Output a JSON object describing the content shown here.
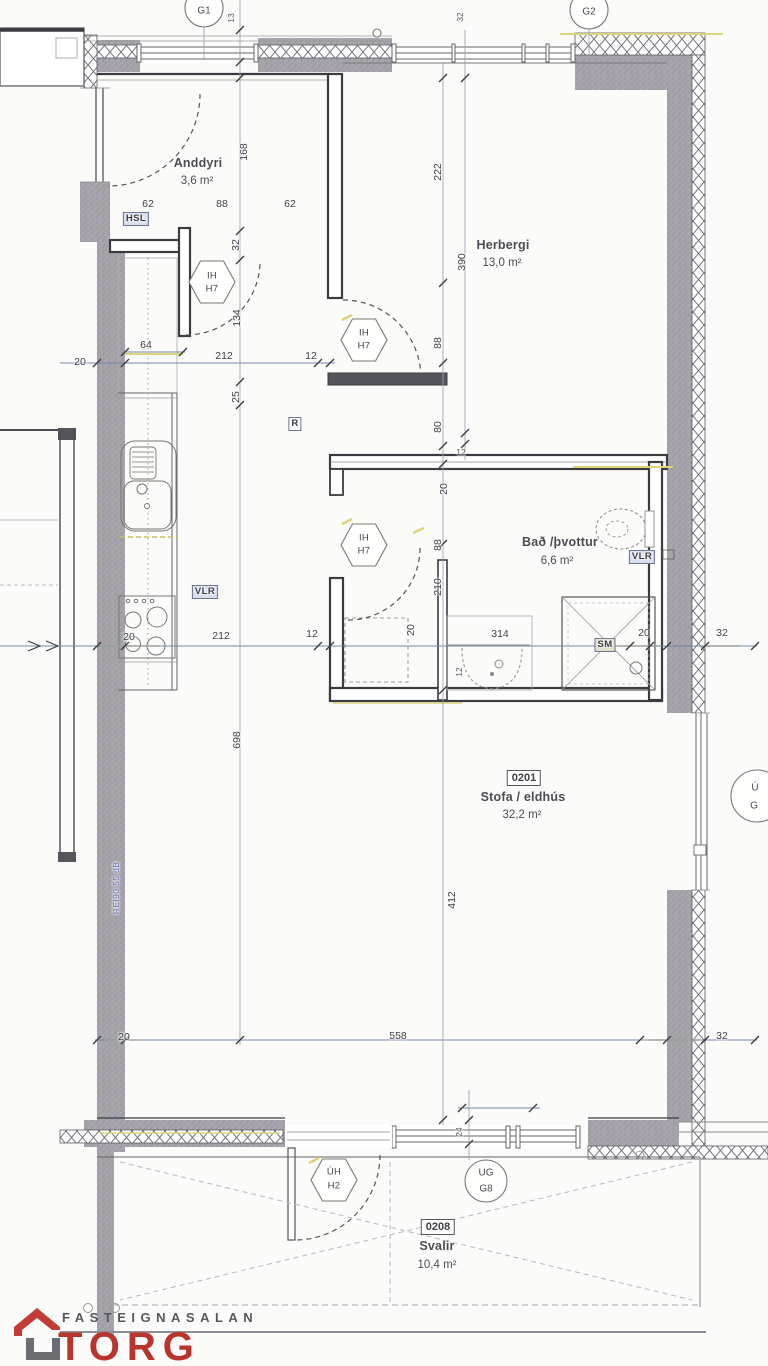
{
  "plan": {
    "grid_circles": {
      "g1": "G1",
      "g2": "G2"
    },
    "window_tag_partial": {
      "line1": "Ú",
      "line2": "G"
    },
    "rooms": {
      "anddyri": {
        "name": "Anddyri",
        "area": "3,6 m²"
      },
      "herbergi": {
        "name": "Herbergi",
        "area": "13,0 m²"
      },
      "bad": {
        "name": "Bað /þvottur",
        "area": "6,6 m²"
      },
      "stofa": {
        "id": "0201",
        "name": "Stofa / eldhús",
        "area": "32,2 m²"
      },
      "svalir": {
        "id": "0208",
        "name": "Svalir",
        "area": "10,4 m²"
      }
    },
    "door_tags": {
      "hex1": {
        "l1": "IH",
        "l2": "H7"
      },
      "hex2": {
        "l1": "IH",
        "l2": "H7"
      },
      "hex3": {
        "l1": "IH",
        "l2": "H7"
      },
      "hex_balcony": {
        "l1": "ÚH",
        "l2": "H2"
      },
      "circle_balcony": {
        "l1": "UG",
        "l2": "G8"
      }
    },
    "fixture_tags": {
      "hsl": "HSL",
      "r": "R",
      "vlr_kitchen": "VLR",
      "vlr_bath": "VLR",
      "sm": "SM"
    },
    "wall_note": "REI90 55 dB",
    "dims": {
      "t62a": "62",
      "t88": "88",
      "t62b": "62",
      "v168": "168",
      "v32": "32",
      "v134": "134",
      "v25": "25",
      "v698": "698",
      "h20": "20",
      "h212": "212",
      "h12": "12",
      "d64": "64",
      "v222": "222",
      "v390": "390",
      "v88a": "88",
      "v80": "80",
      "v12a": "12",
      "v20a": "20",
      "v88b": "88",
      "v210": "210",
      "v20b": "20",
      "v12b": "12",
      "m20": "20",
      "m212": "212",
      "m12": "12",
      "m314": "314",
      "m20b": "20",
      "m32": "32",
      "v412": "412",
      "v24": "24",
      "b20": "20",
      "b558": "558",
      "b32": "32",
      "tiny13": "13",
      "tiny32": "32"
    }
  },
  "logo": {
    "brand_top": "FASTEIGNASALAN",
    "brand": "TORG"
  },
  "colors": {
    "wall_gray": "#a8a4ac",
    "accent_yellow": "#ddd37a",
    "dim_blue": "#6e84a8",
    "logo_red": "#b9342c",
    "logo_gray": "#58585c",
    "note_blue": "#5b6cae"
  }
}
